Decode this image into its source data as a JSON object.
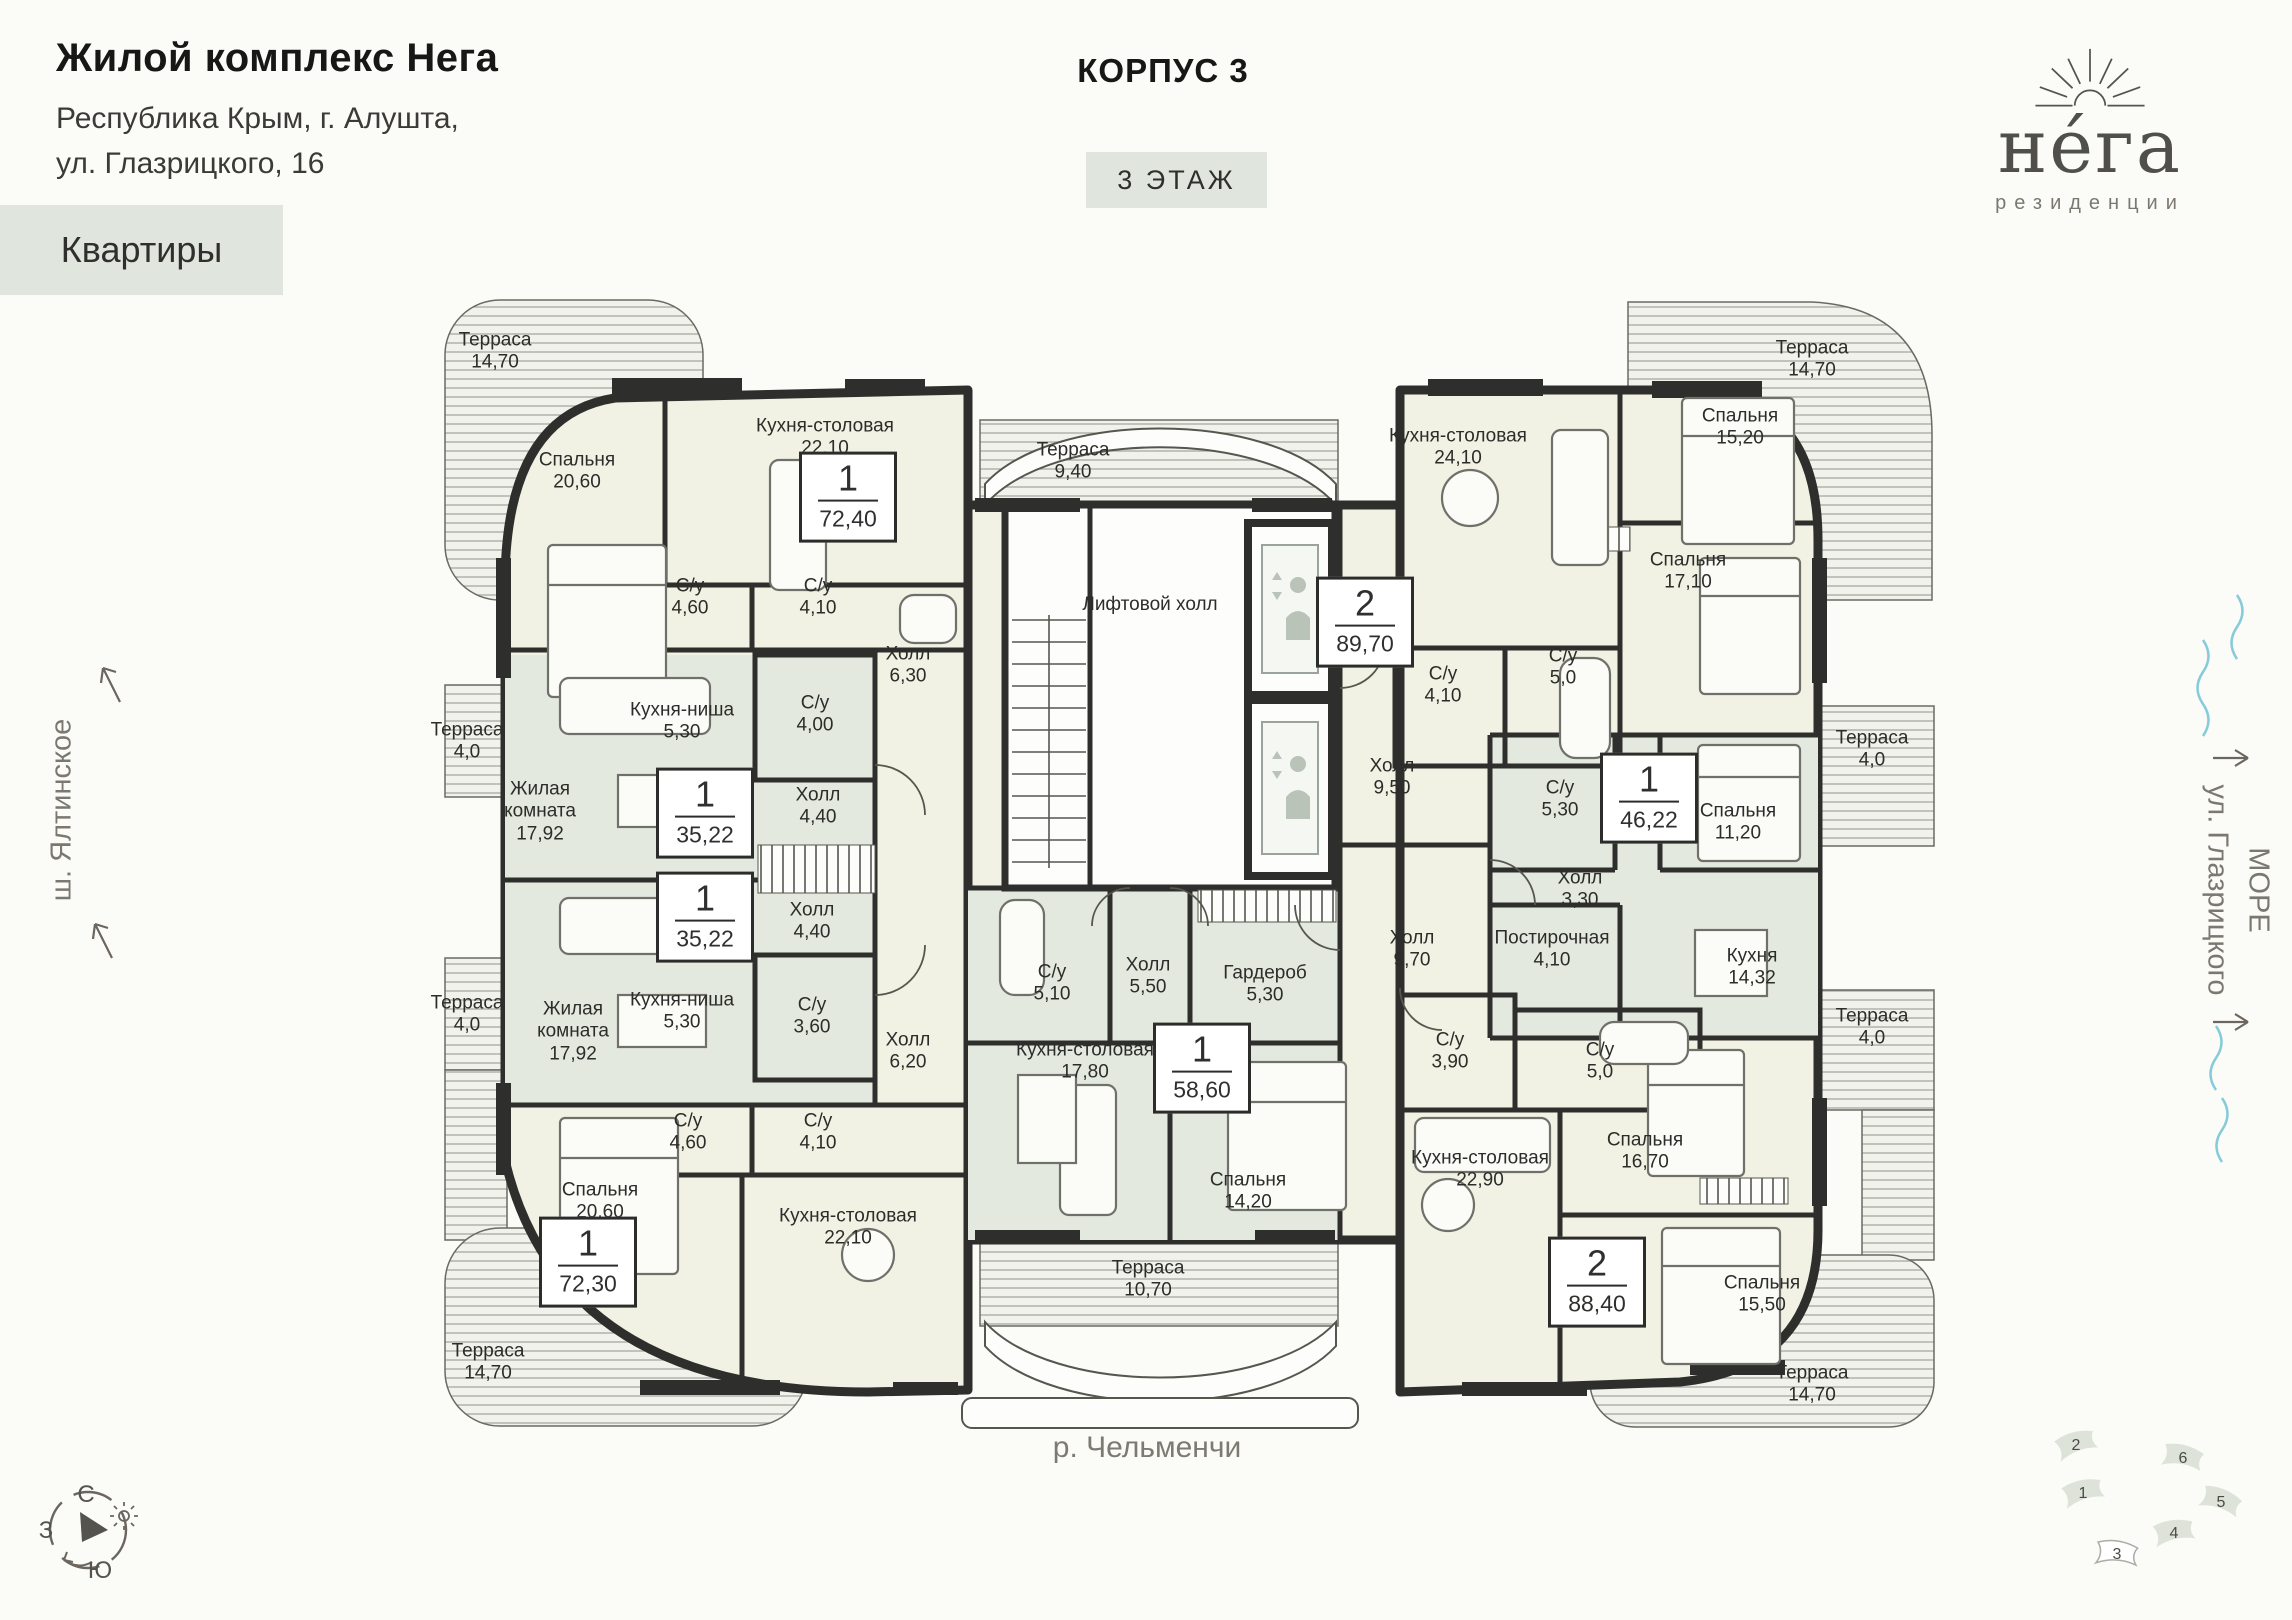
{
  "header": {
    "title": "Жилой комплекс Нега",
    "address_line1": "Республика Крым, г. Алушта,",
    "address_line2": "ул. Глазрицкого, 16",
    "apartments_label": "Квартиры",
    "building": "КОРПУС 3",
    "floor": "3 ЭТАЖ"
  },
  "logo": {
    "name": "не́га",
    "subtitle": "резиденции"
  },
  "surroundings": {
    "left_road": "ш. Ялтинское",
    "sea": "МОРЕ",
    "right_street": "ул. Глазрицкого",
    "river": "р. Чельменчи"
  },
  "compass": {
    "north": "С",
    "west": "З",
    "south": "Ю"
  },
  "minimap": {
    "buildings": [
      {
        "num": "2"
      },
      {
        "num": "6"
      },
      {
        "num": "1"
      },
      {
        "num": "5"
      },
      {
        "num": "4"
      },
      {
        "num": "3"
      }
    ]
  },
  "apartments": [
    {
      "type": "1",
      "area": "72,40"
    },
    {
      "type": "1",
      "area": "35,22"
    },
    {
      "type": "1",
      "area": "35,22"
    },
    {
      "type": "1",
      "area": "72,30"
    },
    {
      "type": "2",
      "area": "89,70"
    },
    {
      "type": "1",
      "area": "46,22"
    },
    {
      "type": "1",
      "area": "58,60"
    },
    {
      "type": "2",
      "area": "88,40"
    }
  ],
  "rooms": [
    {
      "name": "Спальня",
      "area": "20,60"
    },
    {
      "name": "Кухня-столовая",
      "area": "22,10"
    },
    {
      "name": "С/у",
      "area": "4,60"
    },
    {
      "name": "С/у",
      "area": "4,10"
    },
    {
      "name": "Холл",
      "area": "6,30"
    },
    {
      "name": "Терраса",
      "area": "14,70"
    },
    {
      "name": "Терраса",
      "area": "4,0"
    },
    {
      "name": "Кухня-ниша",
      "area": "5,30"
    },
    {
      "name": "С/у",
      "area": "4,00"
    },
    {
      "name": "Жилая комната",
      "area": "17,92"
    },
    {
      "name": "Холл",
      "area": "4,40"
    },
    {
      "name": "Жилая комната",
      "area": "17,92"
    },
    {
      "name": "Кухня-ниша",
      "area": "5,30"
    },
    {
      "name": "С/у",
      "area": "3,60"
    },
    {
      "name": "Холл",
      "area": "4,40"
    },
    {
      "name": "Холл",
      "area": "6,20"
    },
    {
      "name": "Терраса",
      "area": "4,0"
    },
    {
      "name": "С/у",
      "area": "4,60"
    },
    {
      "name": "С/у",
      "area": "4,10"
    },
    {
      "name": "Спальня",
      "area": "20,60"
    },
    {
      "name": "Кухня-столовая",
      "area": "22,10"
    },
    {
      "name": "Терраса",
      "area": "14,70"
    },
    {
      "name": "Терраса",
      "area": "9,40"
    },
    {
      "name": "Лифтовой холл",
      "area": ""
    },
    {
      "name": "Кухня-столовая",
      "area": "24,10"
    },
    {
      "name": "Спальня",
      "area": "15,20"
    },
    {
      "name": "Спальня",
      "area": "17,10"
    },
    {
      "name": "С/у",
      "area": "4,10"
    },
    {
      "name": "С/у",
      "area": "5,0"
    },
    {
      "name": "Холл",
      "area": "9,50"
    },
    {
      "name": "С/у",
      "area": "5,30"
    },
    {
      "name": "Спальня",
      "area": "11,20"
    },
    {
      "name": "Терраса",
      "area": "4,0"
    },
    {
      "name": "Холл",
      "area": "3,30"
    },
    {
      "name": "Постирочная",
      "area": "4,10"
    },
    {
      "name": "Кухня",
      "area": "14,32"
    },
    {
      "name": "Терраса",
      "area": "4,0"
    },
    {
      "name": "Терраса",
      "area": "14,70"
    },
    {
      "name": "С/у",
      "area": "5,10"
    },
    {
      "name": "Холл",
      "area": "5,50"
    },
    {
      "name": "Гардероб",
      "area": "5,30"
    },
    {
      "name": "Кухня-столовая",
      "area": "17,80"
    },
    {
      "name": "Спальня",
      "area": "14,20"
    },
    {
      "name": "Терраса",
      "area": "10,70"
    },
    {
      "name": "Холл",
      "area": "9,70"
    },
    {
      "name": "С/у",
      "area": "3,90"
    },
    {
      "name": "С/у",
      "area": "5,0"
    },
    {
      "name": "Кухня-столовая",
      "area": "22,90"
    },
    {
      "name": "Спальня",
      "area": "16,70"
    },
    {
      "name": "Спальня",
      "area": "15,50"
    },
    {
      "name": "Терраса",
      "area": "14,70"
    }
  ]
}
